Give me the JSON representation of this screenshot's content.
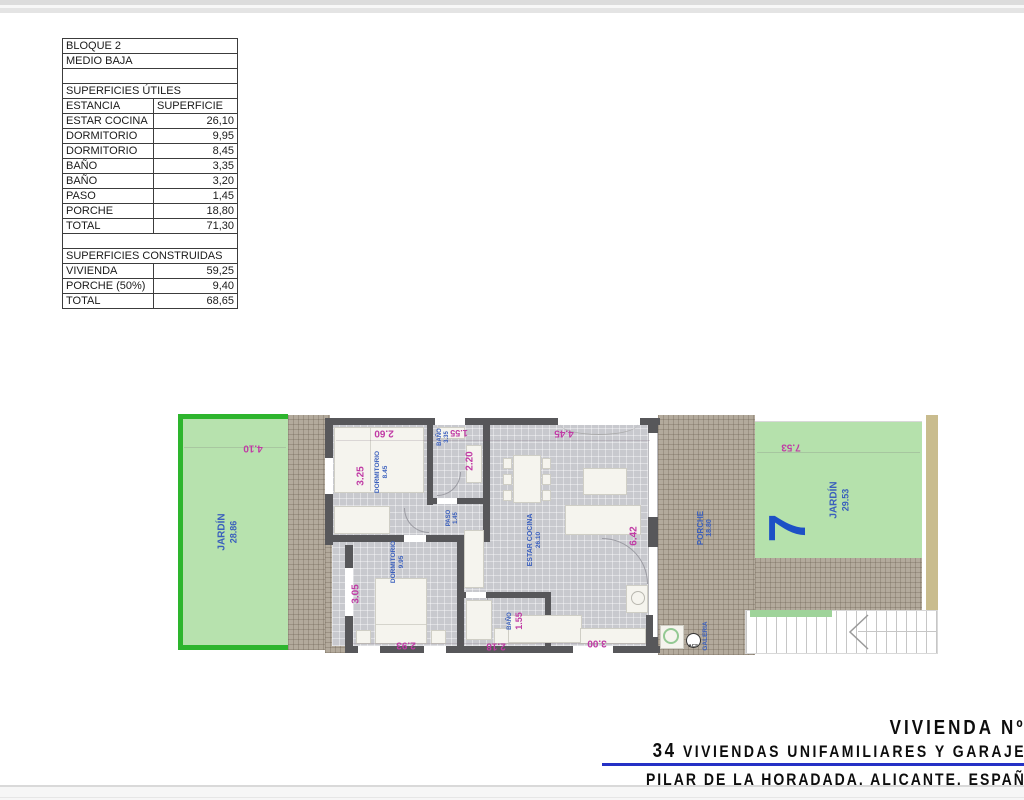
{
  "table": {
    "rows": [
      {
        "label": "BLOQUE 2",
        "value": ""
      },
      {
        "label": "MEDIO BAJA",
        "value": ""
      },
      {
        "label": "",
        "value": ""
      },
      {
        "label": "SUPERFICIES ÚTILES",
        "value": ""
      },
      {
        "label": "ESTANCIA",
        "value": "SUPERFICIE"
      },
      {
        "label": "ESTAR COCINA",
        "value": "26,10"
      },
      {
        "label": "DORMITORIO",
        "value": "9,95"
      },
      {
        "label": "DORMITORIO",
        "value": "8,45"
      },
      {
        "label": "BAÑO",
        "value": "3,35"
      },
      {
        "label": "BAÑO",
        "value": "3,20"
      },
      {
        "label": "PASO",
        "value": "1,45"
      },
      {
        "label": "PORCHE",
        "value": "18,80"
      },
      {
        "label": "TOTAL",
        "value": "71,30"
      },
      {
        "label": "",
        "value": ""
      },
      {
        "label": "SUPERFICIES CONSTRUIDAS",
        "value": ""
      },
      {
        "label": "VIVIENDA",
        "value": "59,25"
      },
      {
        "label": "PORCHE (50%)",
        "value": "9,40"
      },
      {
        "label": "TOTAL",
        "value": "68,65"
      }
    ]
  },
  "plan": {
    "garden_left": {
      "name": "JARDÍN",
      "area": "28.86",
      "dim_width": "4.10"
    },
    "garden_right": {
      "name": "JARDÍN",
      "area": "29.53",
      "dim_width": "7.53",
      "unit": "7"
    },
    "porche": {
      "name": "PORCHE",
      "area": "18.80"
    },
    "galeria": {
      "name": "GALERIA",
      "acs": "ACS"
    },
    "rooms": {
      "dorm1": {
        "name": "DORMITORIO",
        "area": "8.45",
        "dim_v": "3.25",
        "dim_h": "2.60"
      },
      "bath1": {
        "name": "BAÑO",
        "area": "3.35",
        "dim_v": "2.20",
        "dim_h": "1.55"
      },
      "paso": {
        "name": "PASO",
        "area": "1.45"
      },
      "dorm2": {
        "name": "DORMITORIO",
        "area": "9.95",
        "dim_v": "3.05",
        "dim_h": "2.93"
      },
      "bath2": {
        "name": "BAÑO",
        "dim_v": "1.55",
        "dim_h": "2.18"
      },
      "living": {
        "name": "ESTAR COCINA",
        "area": "26.10",
        "dim_top": "4.45",
        "dim_right": "6.42",
        "dim_bottom": "3.00"
      }
    }
  },
  "title": {
    "line1": "VIVIENDA Nº7",
    "line2_num": "34",
    "line2_text": " VIVIENDAS UNIFAMILIARES Y GARAJES",
    "line3": "PILAR DE LA HORADADA. ALICANTE. ESPAÑA"
  },
  "colors": {
    "garden_border": "#2db52d",
    "garden_fill": "#b7e2ae",
    "wall": "#57575a",
    "dim_text": "#c03ba5",
    "room_label": "#3a5fbd",
    "unit_number": "#1d50c5",
    "title_rule": "#2531c5"
  }
}
